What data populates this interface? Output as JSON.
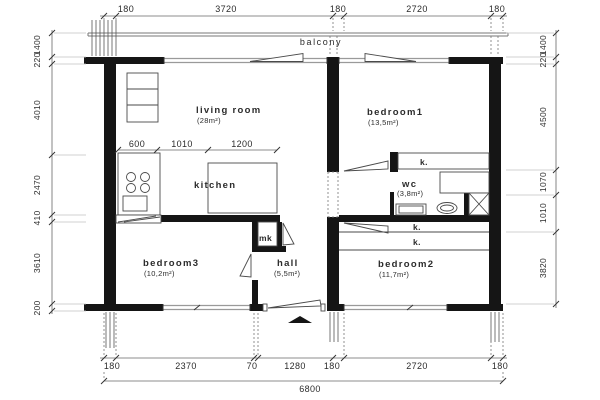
{
  "colors": {
    "wall": "#151515",
    "line": "#4a4a4a",
    "thin": "#9a9a9a",
    "text": "#2b2b2b"
  },
  "rooms": {
    "balcony": {
      "name": "balcony"
    },
    "living_room": {
      "name": "living room",
      "area": "(28m²)"
    },
    "bedroom1": {
      "name": "bedroom1",
      "area": "(13,5m²)"
    },
    "kitchen": {
      "name": "kitchen"
    },
    "wc": {
      "name": "wc",
      "area": "(3,8m²)"
    },
    "bedroom3": {
      "name": "bedroom3",
      "area": "(10,2m²)"
    },
    "hall": {
      "name": "hall",
      "area": "(5,5m²)"
    },
    "bedroom2": {
      "name": "bedroom2",
      "area": "(11,7m²)"
    }
  },
  "closets": {
    "mk": "mk",
    "k_bedroom1": "k.",
    "k_corridor": "k.",
    "k_bedroom2": "k."
  },
  "dims": {
    "top": [
      "180",
      "3720",
      "180",
      "2720",
      "180"
    ],
    "bottom": [
      "180",
      "2370",
      "70",
      "1280",
      "180",
      "2720",
      "180"
    ],
    "total_width": "6800",
    "left": [
      "1400",
      "220",
      "4010",
      "2470",
      "410",
      "3610",
      "200"
    ],
    "right": [
      "1400",
      "220",
      "4500",
      "1070",
      "1010",
      "3820"
    ],
    "kitchen": [
      "600",
      "1010",
      "1200"
    ]
  }
}
